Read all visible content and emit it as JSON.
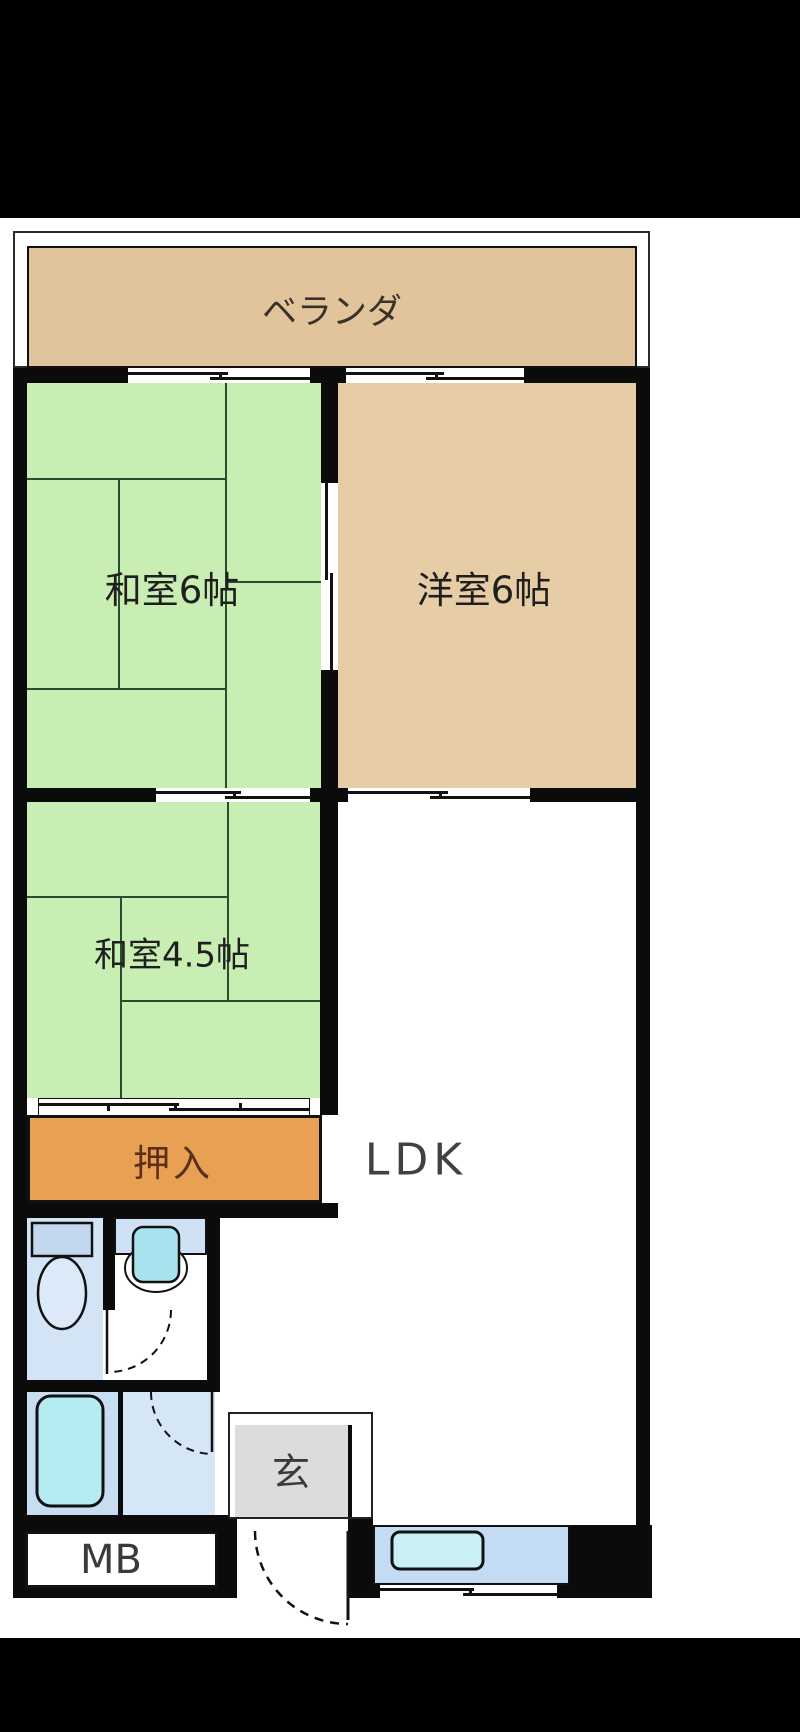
{
  "page": {
    "kind": "apartment floor plan image",
    "background": "#ffffff",
    "letterbox_color": "#000000"
  },
  "floor_plan": {
    "labels": {
      "veranda": "ベランダ",
      "washitsu6": "和室6帖",
      "youshitsu6": "洋室6帖",
      "washitsu45": "和室4.5帖",
      "oshiire": "押入",
      "ldk": "LDK",
      "genkan": "玄",
      "meter_box": "MB"
    },
    "colors": {
      "wall": "#0b0b0b",
      "tatami_green": "#c9eeb3",
      "tatami_line": "#2c4c2e",
      "western_room_tan": "#e7cda5",
      "veranda_tan": "#e2c49c",
      "closet_orange": "#e8a052",
      "closet_text": "#5d2e1e",
      "entrance_gray": "#dcdcdc",
      "water_room_blue": "#cfe2f5",
      "fixture_cyan": "#b5ecf2"
    },
    "fixtures": [
      "toilet-icon",
      "washbasin-icon",
      "bathtub-icon",
      "kitchen-sink-icon"
    ],
    "doors": [
      "toilet-door-swing",
      "washroom-door-swing",
      "entrance-door-swing"
    ],
    "windows": [
      "balcony-window-left",
      "balcony-window-right",
      "tatami-sliding-door",
      "ldk-sliding-window",
      "closet-fusuma",
      "kitchen-window"
    ]
  }
}
